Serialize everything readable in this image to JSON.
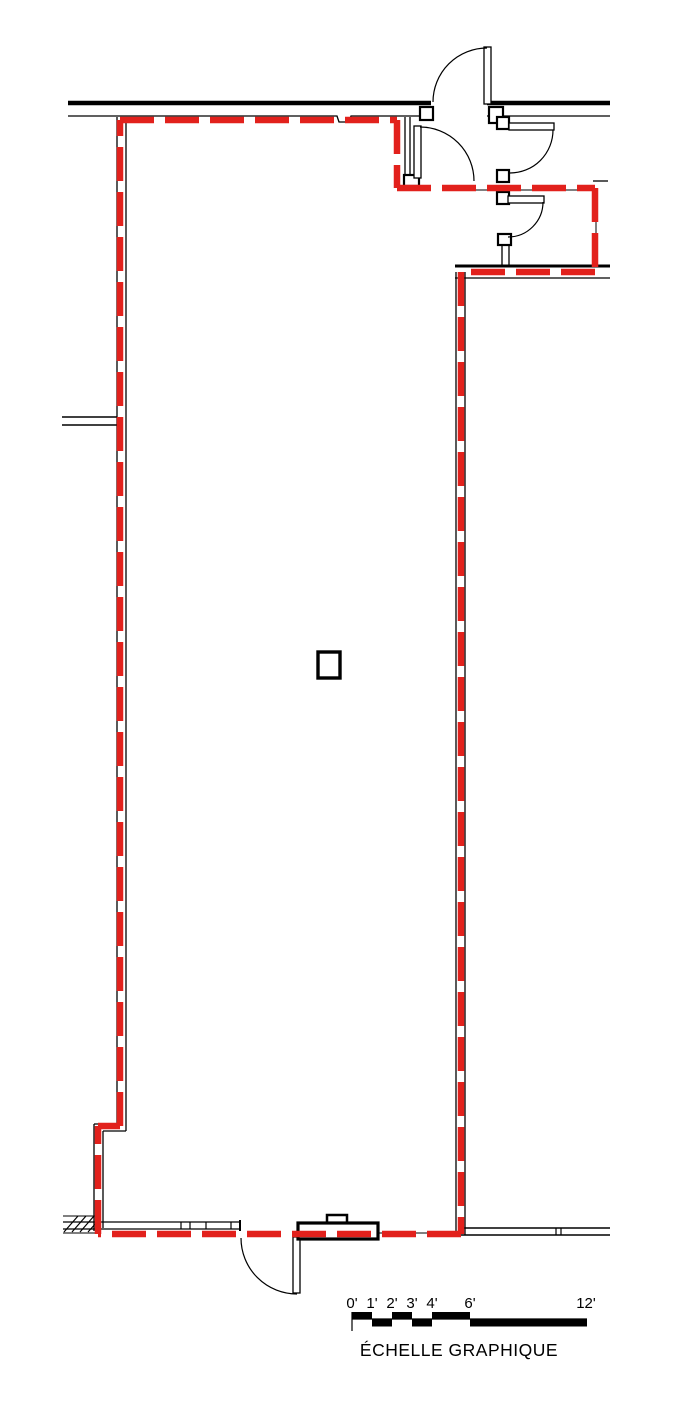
{
  "scale_bar": {
    "labels": [
      {
        "text": "0'"
      },
      {
        "text": "1'"
      },
      {
        "text": "2'"
      },
      {
        "text": "3'"
      },
      {
        "text": "4'"
      },
      {
        "text": "6'"
      },
      {
        "text": "12'"
      }
    ],
    "caption": "ÉCHELLE GRAPHIQUE"
  },
  "colors": {
    "lease_line": "#e2211c",
    "wall": "#000000",
    "background": "#ffffff"
  }
}
